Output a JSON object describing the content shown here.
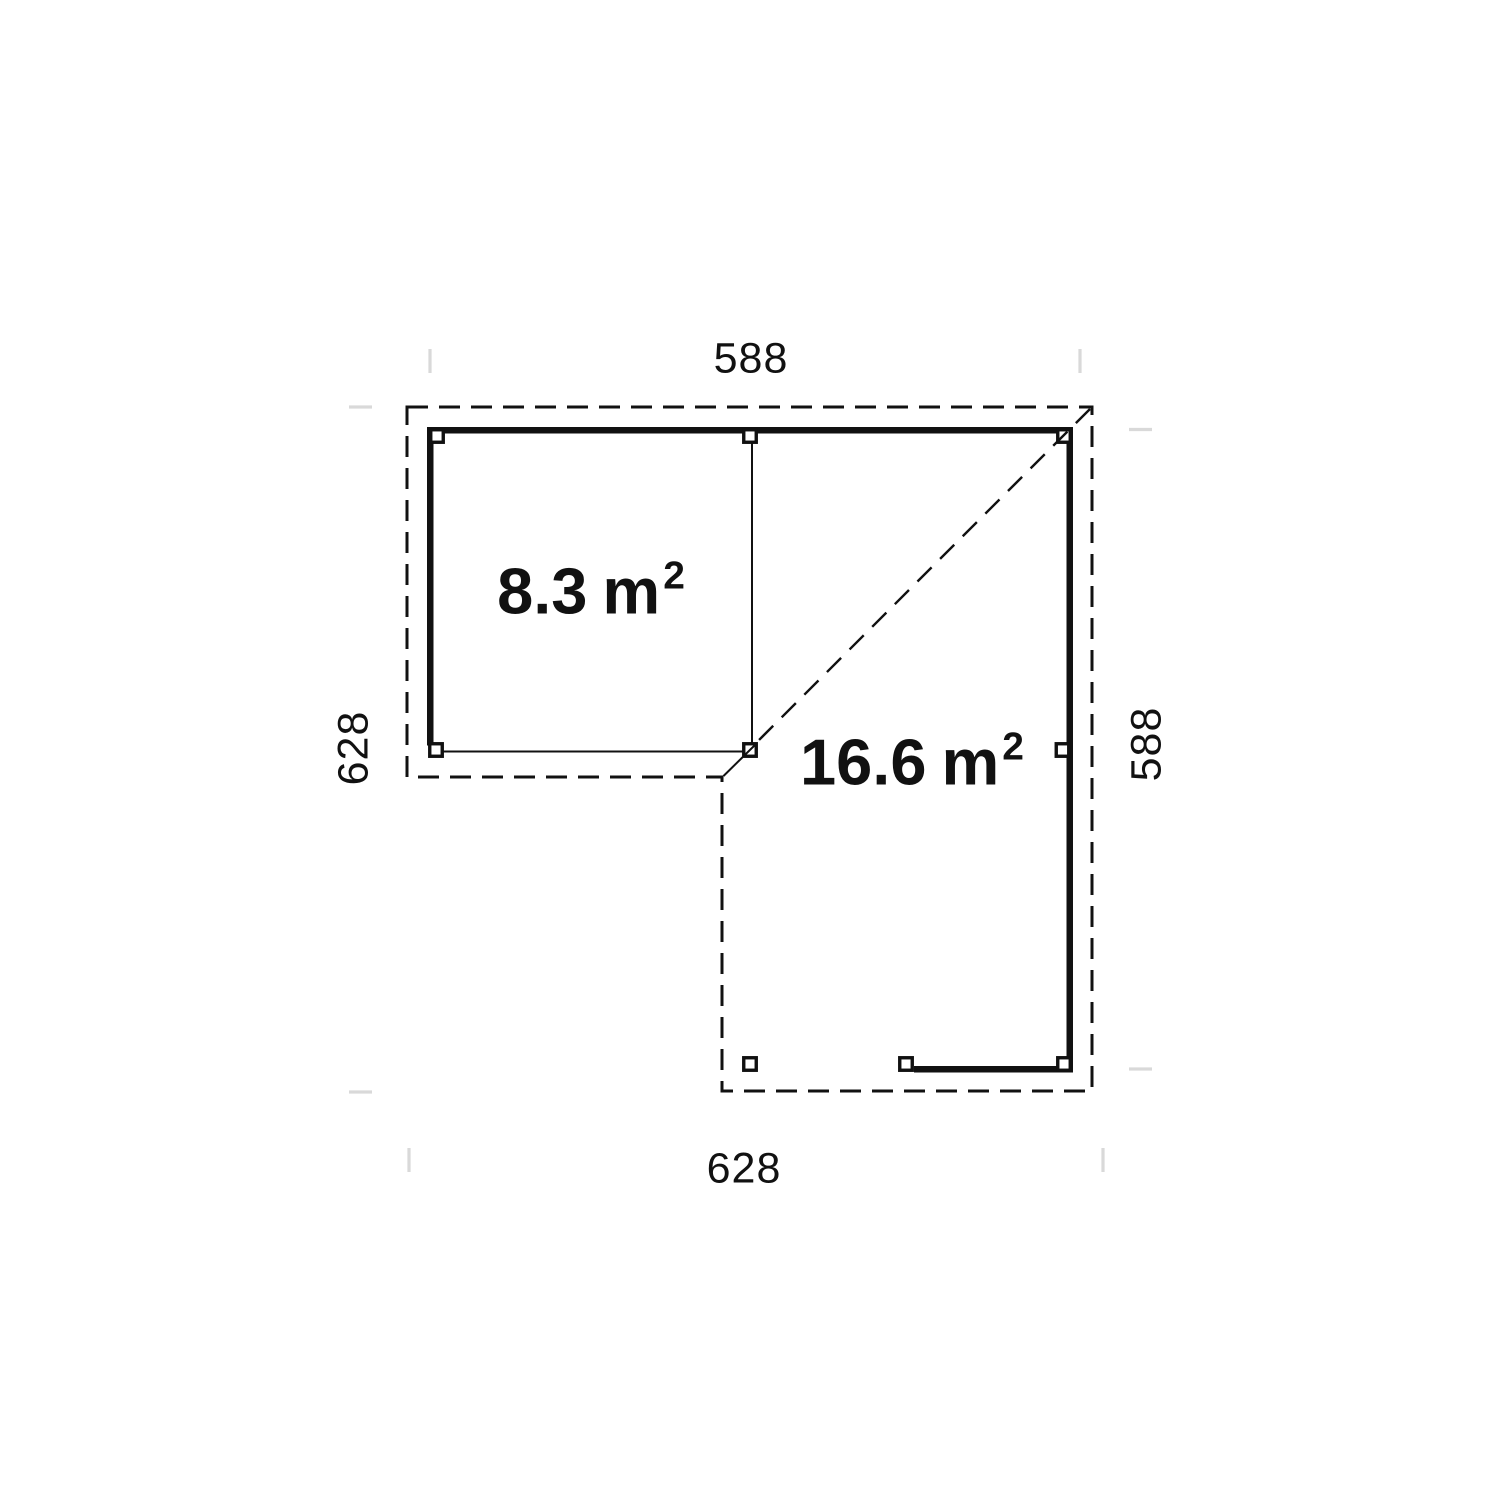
{
  "plan": {
    "type": "floor-plan",
    "dimension_labels": {
      "top": "588",
      "right": "588",
      "bottom": "628",
      "left": "628"
    },
    "rooms": [
      {
        "id": "room-small",
        "area_value": "8.3",
        "area_unit": "m",
        "area_exponent": "2"
      },
      {
        "id": "room-large",
        "area_value": "16.6",
        "area_unit": "m",
        "area_exponent": "2"
      }
    ],
    "colors": {
      "line": "#111111",
      "dimension_tick": "#d9d9d9",
      "post_fill": "#ffffff",
      "background": "#ffffff"
    }
  }
}
